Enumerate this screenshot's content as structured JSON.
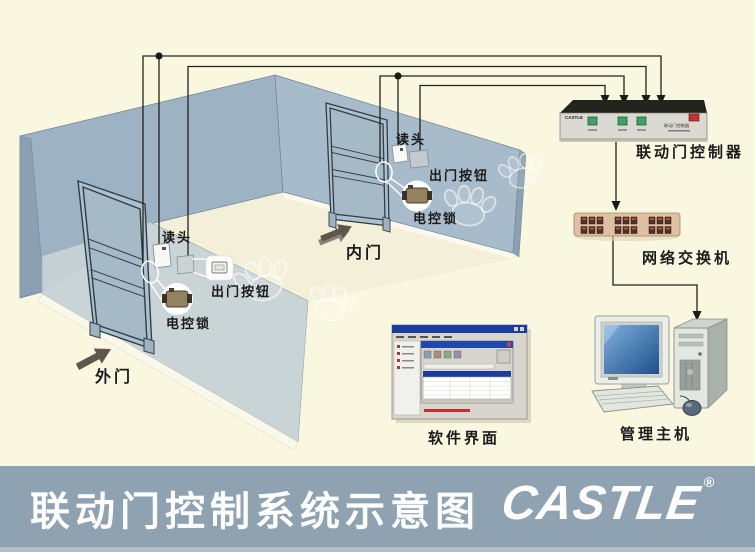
{
  "footer": {
    "title": "联动门控制系统示意图",
    "logo": "CASTLE",
    "registered": "®"
  },
  "outer_door": {
    "door_label": "外门",
    "reader_label": "读头",
    "exit_button_label": "出门按钮",
    "lock_label": "电控锁"
  },
  "inner_door": {
    "door_label": "内门",
    "reader_label": "读头",
    "exit_button_label": "出门按钮",
    "lock_label": "电控锁"
  },
  "controller": {
    "label": "联动门控制器",
    "brand": "CASTLE",
    "face_text": "联动门控制器"
  },
  "network_switch": {
    "label": "网络交换机"
  },
  "software": {
    "label": "软件界面"
  },
  "host": {
    "label": "管理主机"
  },
  "colors": {
    "background": "#faf7e0",
    "wall_back_left": "#9db2c3",
    "wall_back_right": "#a7bbca",
    "wall_front_light": "#c6d1d4",
    "footer_bar": "#8fa2b1",
    "footer_strip": "#b3c0ca",
    "wire": "#23231c",
    "led_green": "#41a065",
    "indicator_red": "#c23333",
    "switch_body": "#dcc2a2",
    "screen_blue": "#2a5a96",
    "lock_body": "#93825f",
    "title_text": "#ffffff",
    "label_text": "#1b1b1b"
  }
}
